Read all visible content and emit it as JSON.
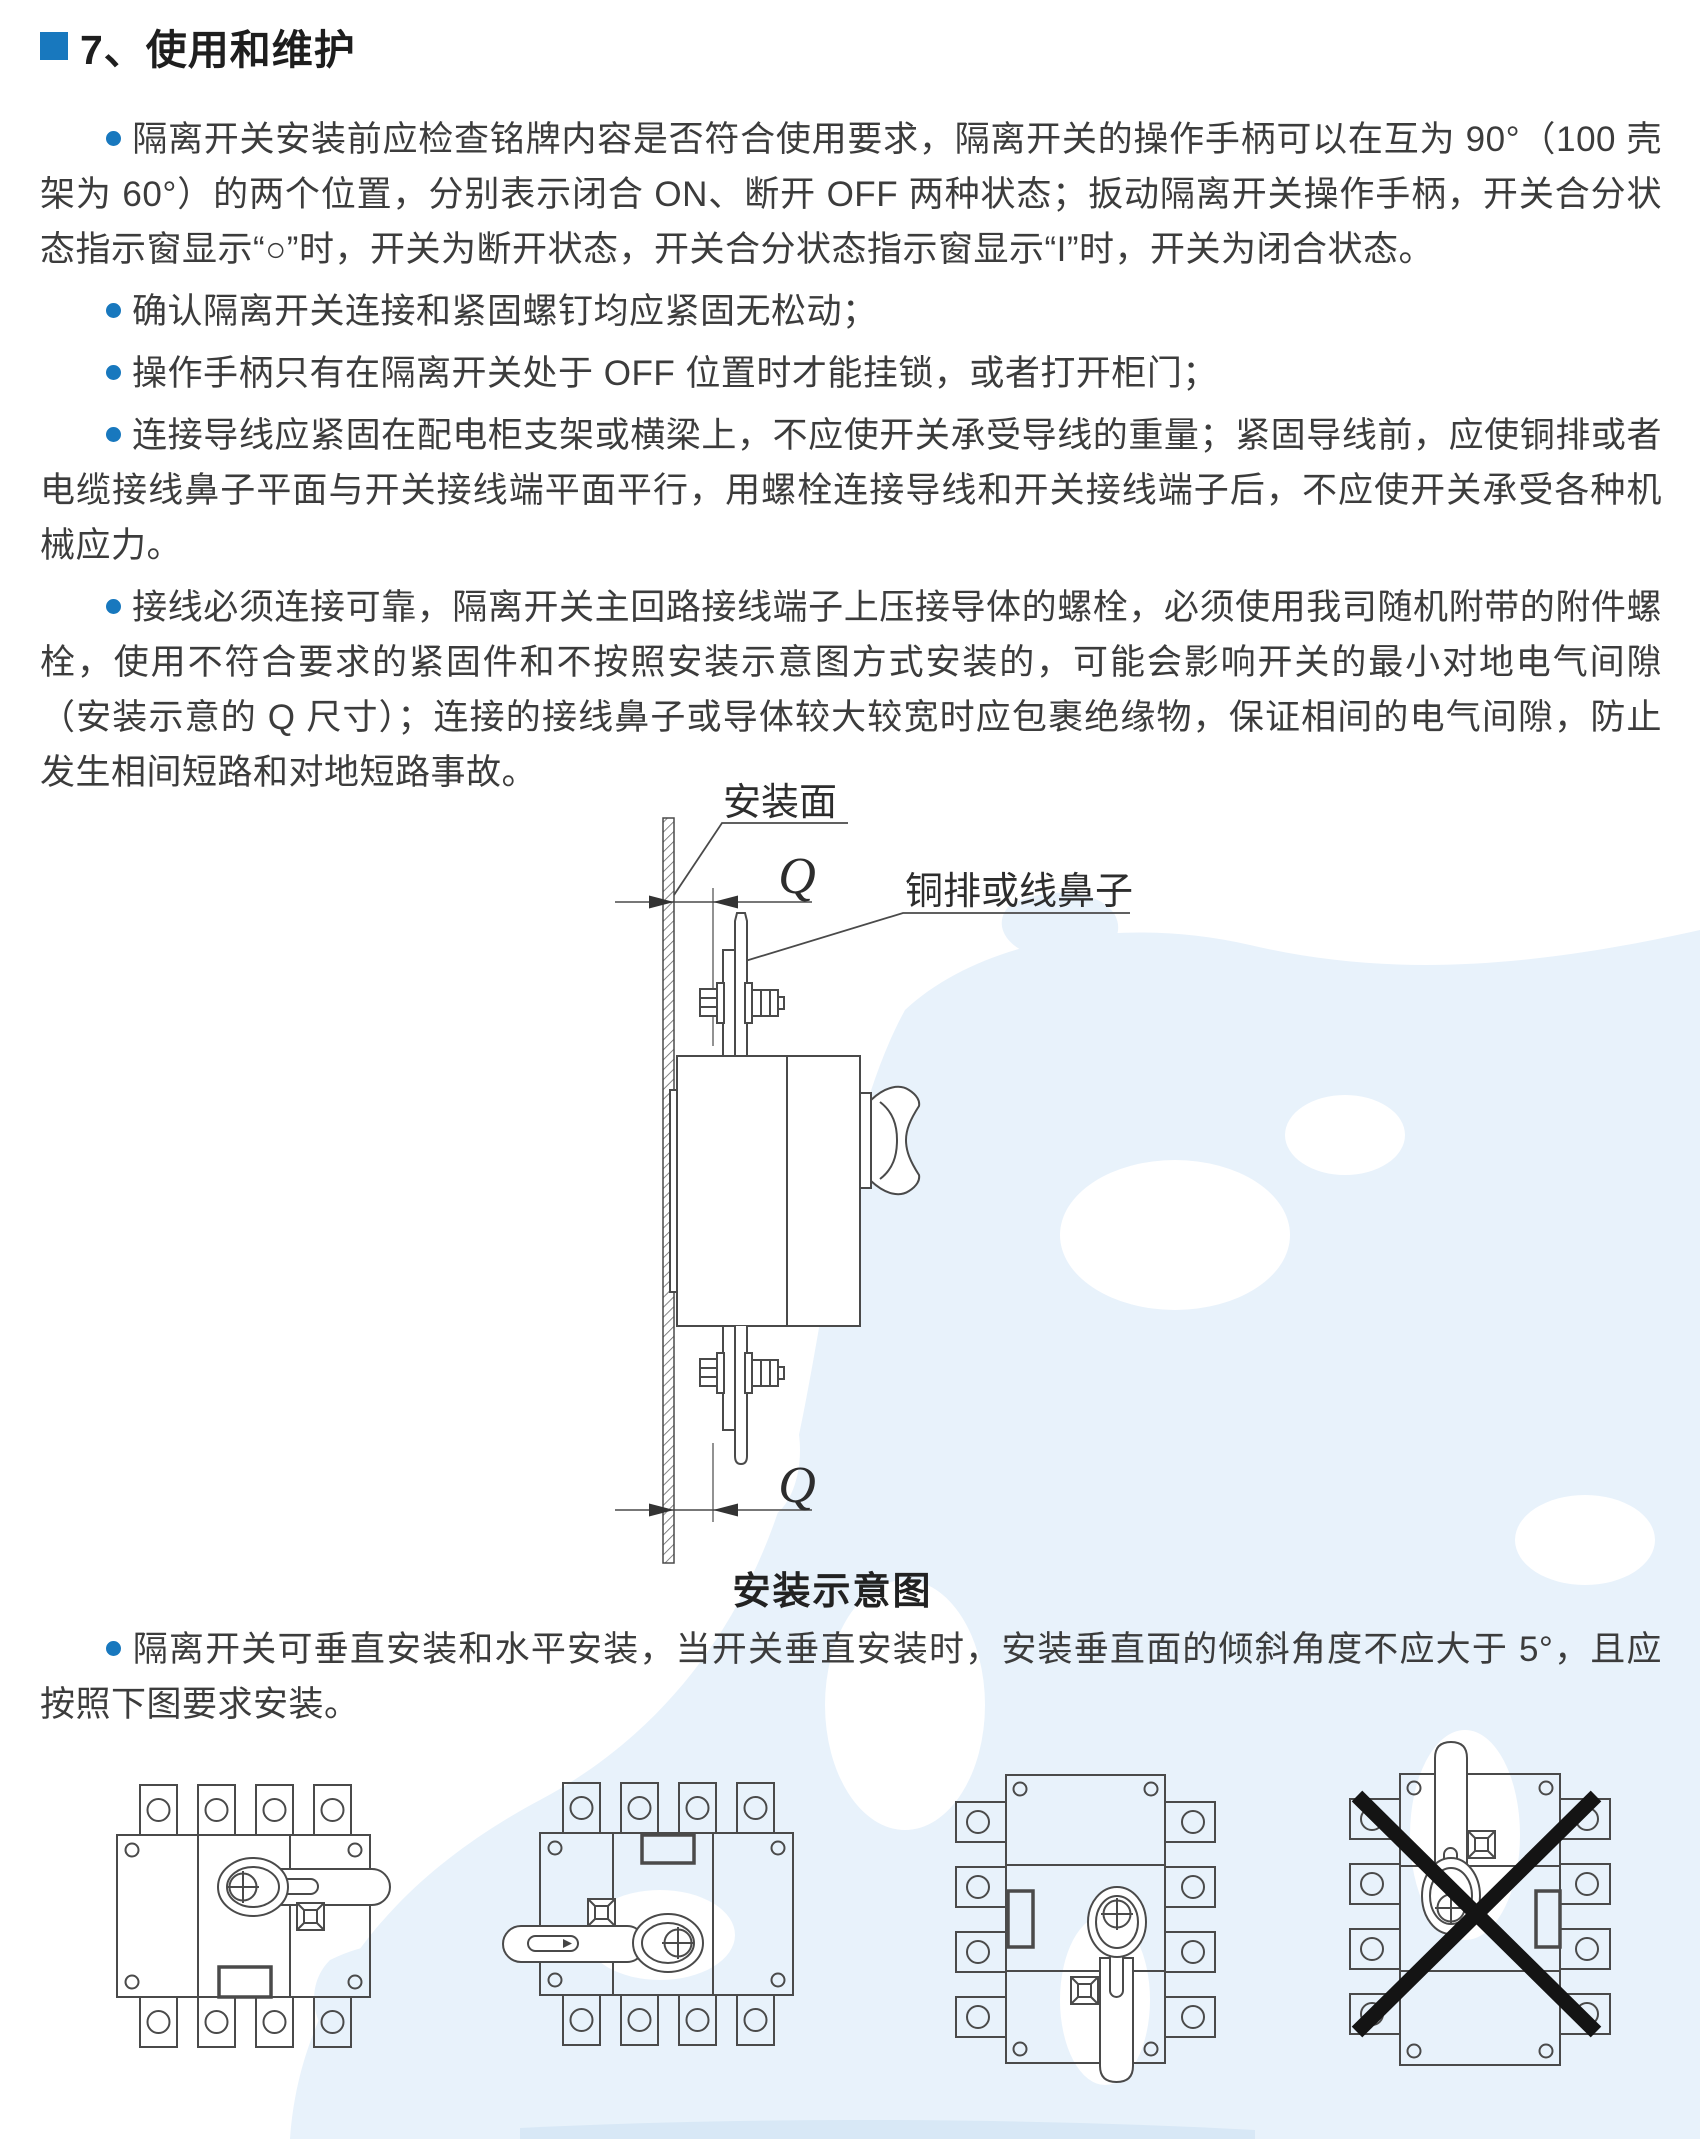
{
  "colors": {
    "accent_blue": "#1878be",
    "body_text": "#3c3c3c",
    "watermark_blue": "#e8f2fb",
    "prohibition_x": "#141414"
  },
  "document": {
    "header": {
      "title": "7、使用和维护"
    },
    "bullets": [
      "隔离开关安装前应检查铭牌内容是否符合使用要求，隔离开关的操作手柄可以在互为 90°（100 壳架为 60°）的两个位置，分别表示闭合 ON、断开 OFF 两种状态；扳动隔离开关操作手柄，开关合分状态指示窗显示“○”时，开关为断开状态，开关合分状态指示窗显示“I”时，开关为闭合状态。",
      "确认隔离开关连接和紧固螺钉均应紧固无松动；",
      "操作手柄只有在隔离开关处于 OFF 位置时才能挂锁，或者打开柜门；",
      "连接导线应紧固在配电柜支架或横梁上，不应使开关承受导线的重量；紧固导线前，应使铜排或者电缆接线鼻子平面与开关接线端平面平行，用螺栓连接导线和开关接线端子后，不应使开关承受各种机械应力。",
      "接线必须连接可靠，隔离开关主回路接线端子上压接导体的螺栓，必须使用我司随机附带的附件螺栓，使用不符合要求的紧固件和不按照安装示意图方式安装的，可能会影响开关的最小对地电气间隙（安装示意的 Q 尺寸）；连接的接线鼻子或导体较大较宽时应包裹绝缘物，保证相间的电气间隙，防止发生相间短路和对地短路事故。",
      "隔离开关可垂直安装和水平安装，当开关垂直安装时，安装垂直面的倾斜角度不应大于 5°，且应按照下图要求安装。"
    ],
    "install_diagram": {
      "mounting_surface_label": "安装面",
      "busbar_label": "铜排或线鼻子",
      "q_dimension_top": "Q",
      "q_dimension_bottom": "Q",
      "caption": "安装示意图"
    }
  }
}
